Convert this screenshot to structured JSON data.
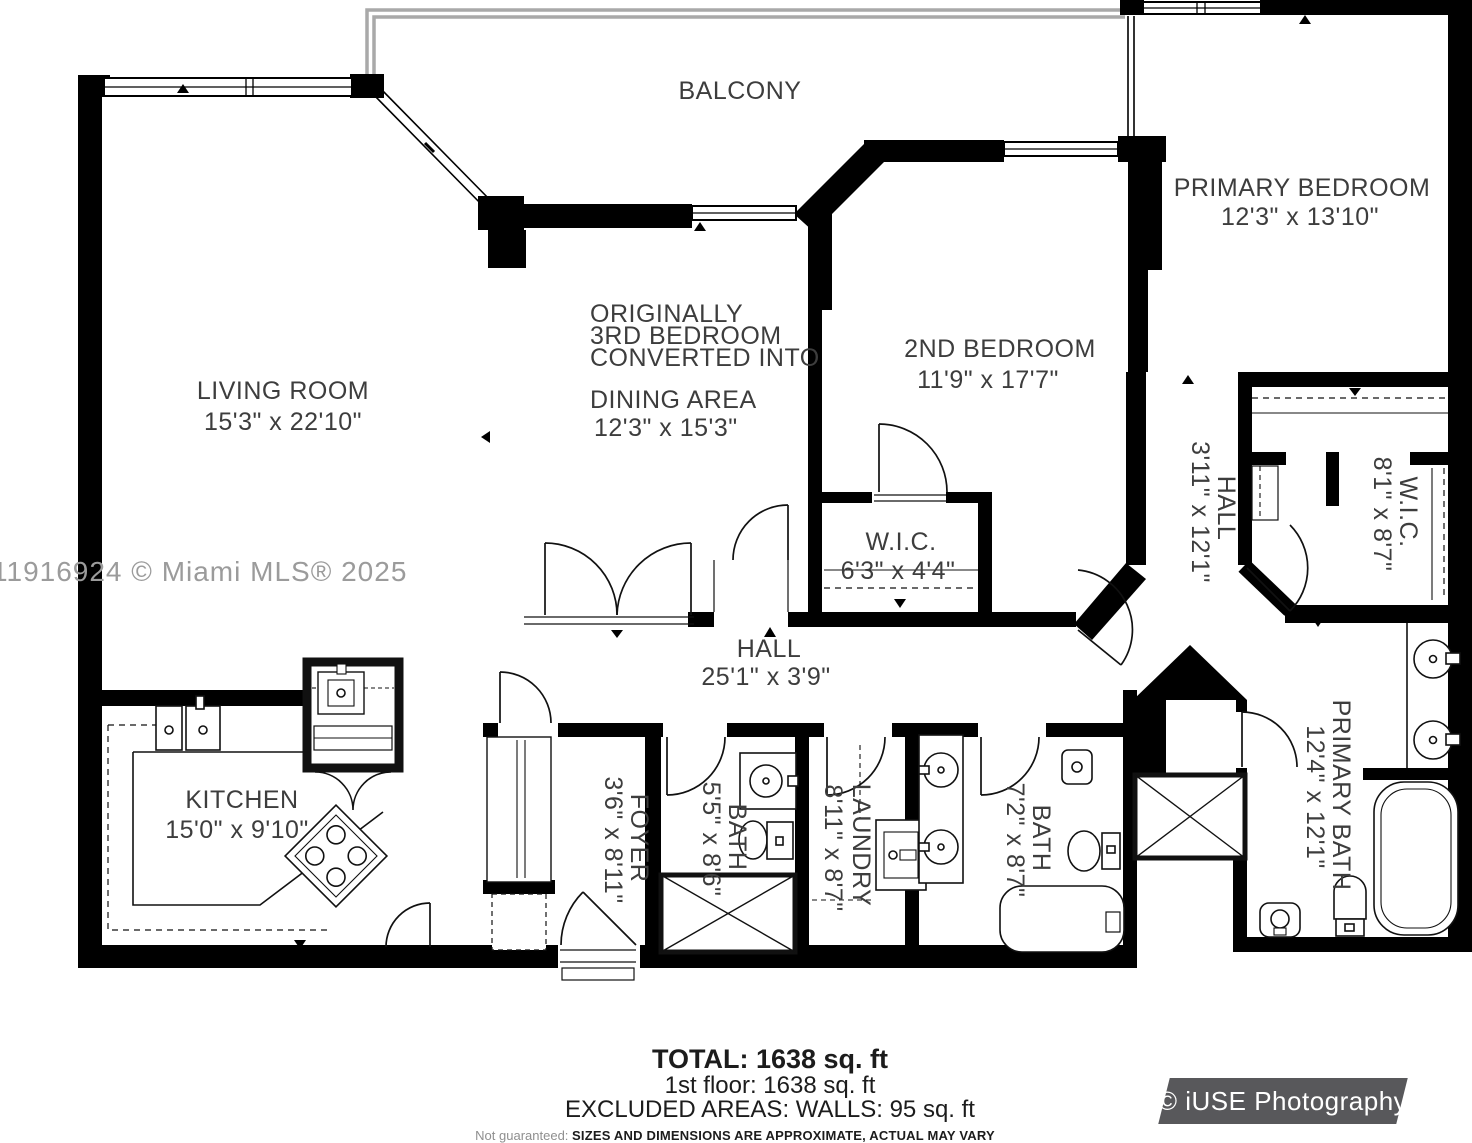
{
  "watermark": "11916924 © Miami MLS® 2025",
  "rooms": {
    "balcony": {
      "name": "BALCONY"
    },
    "living_room": {
      "name": "LIVING ROOM",
      "dims": "15'3\" x 22'10\""
    },
    "dining_area": {
      "note_line1": "ORIGINALLY",
      "note_line2": "3RD BEDROOM",
      "note_line3": "CONVERTED INTO",
      "name": "DINING AREA",
      "dims": "12'3\" x 15'3\""
    },
    "second_bedroom": {
      "name": "2ND BEDROOM",
      "dims": "11'9\" x 17'7\""
    },
    "primary_bedroom": {
      "name": "PRIMARY BEDROOM",
      "dims": "12'3\" x 13'10\""
    },
    "wic_bedroom2": {
      "name": "W.I.C.",
      "dims": "6'3\" x 4'4\""
    },
    "hall_primary": {
      "name": "HALL",
      "dims": "3'11\" x 12'1\""
    },
    "wic_primary": {
      "name": "W.I.C.",
      "dims": "8'1\" x 8'7\""
    },
    "hall_main": {
      "name": "HALL",
      "dims": "25'1\" x 3'9\""
    },
    "kitchen": {
      "name": "KITCHEN",
      "dims": "15'0\" x 9'10\""
    },
    "foyer": {
      "name": "FOYER",
      "dims": "3'6\" x 8'11\""
    },
    "bath_hall": {
      "name": "BATH",
      "dims": "5'5\" x 8'6\""
    },
    "laundry": {
      "name": "LAUNDRY",
      "dims": "8'11\" x 8'7\""
    },
    "bath_second": {
      "name": "BATH",
      "dims": "7'2\" x 8'7\""
    },
    "primary_bath": {
      "name": "PRIMARY BATH",
      "dims": "12'4\" x 12'1\""
    }
  },
  "footer": {
    "total": "TOTAL: 1638 sq. ft",
    "first_floor": "1st floor: 1638 sq. ft",
    "excluded": "EXCLUDED AREAS: WALLS: 95 sq. ft",
    "disclaimer_label": "Not guaranteed:",
    "disclaimer_text": "SIZES AND DIMENSIONS ARE APPROXIMATE, ACTUAL MAY VARY"
  },
  "branding": {
    "logo_text": "© iUSE Photography"
  },
  "colors": {
    "wall": "#000000",
    "railing": "#a9a9a9",
    "label": "#3d3d3d",
    "watermark": "#9b9b9b",
    "logo_bg": "#58585b",
    "logo_text": "#ffffff",
    "background": "#ffffff"
  }
}
